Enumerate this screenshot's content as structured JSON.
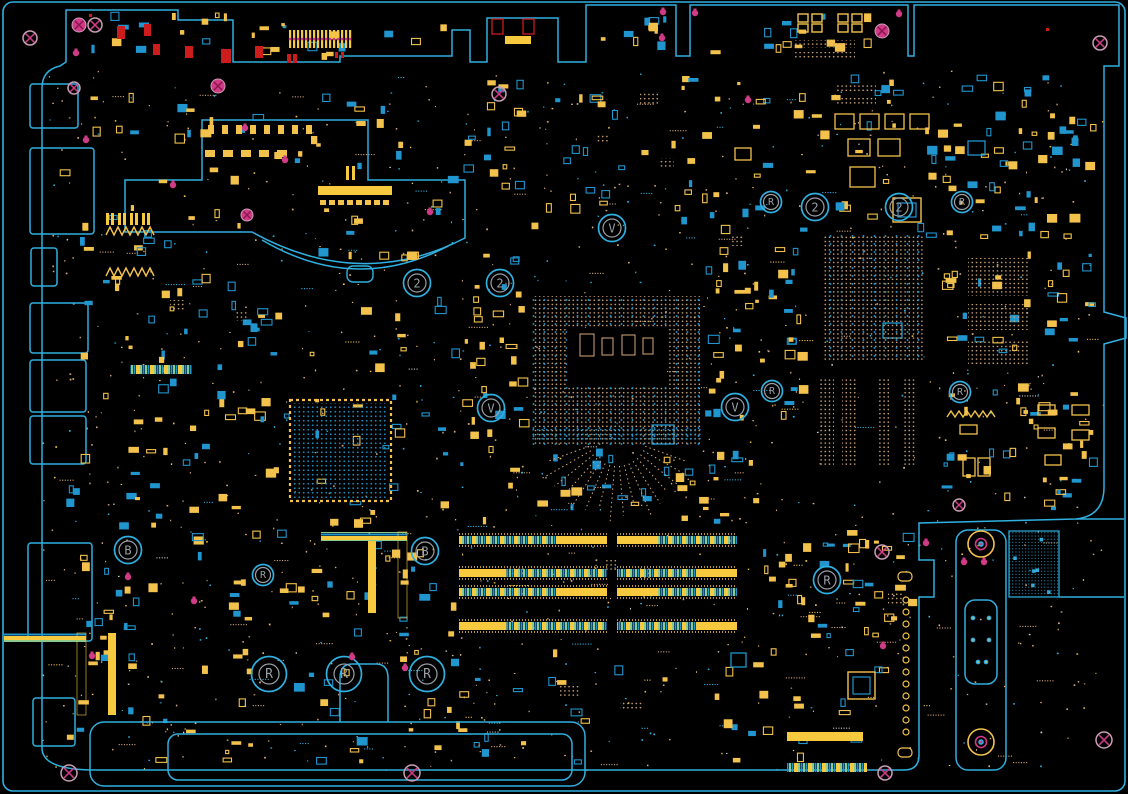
{
  "meta": {
    "type": "pcb-boardview",
    "width": 1128,
    "height": 794
  },
  "colors": {
    "bg": "#000000",
    "outline": "#2fb0e0",
    "blue": "#2095ce",
    "yellow": "#f2c24c",
    "yellowBright": "#f6c93f",
    "tan": "#d4a97c",
    "green": "#8cc98c",
    "magenta": "#d13a86",
    "magentaDark": "#8c1650",
    "grayPink": "#c89fb6",
    "red": "#cc1c1c",
    "gray": "#9aa0a6"
  },
  "outline_paths": {
    "main_board": "M 66,62 L 66,10 L 178,10 L 178,20 L 233,20 L 233,62 L 340,62 L 340,56 L 452,56 L 452,30 L 470,30 L 470,62 L 487,62 L 487,18 L 558,18 L 558,62 L 586,62 L 586,5 L 676,5 L 676,56 L 690,56 L 690,5 L 908,5 L 908,56 L 914,56 L 914,5 L 1119,5 L 1119,66 L 1104,66 L 1104,312 L 1126,318 L 1126,338 L 1104,344 L 1104,487 Q 1104,516 1076,519 L 919,523 L 919,560 L 934,560 L 934,597 L 919,597 L 919,755 Q 919,770 904,770 L 95,770 Q 42,770 42,748 L 42,88 Q 42,70 60,66 Z",
    "top_connector_block": "M 125,232 L 125,180 L 202,180 L 202,120 L 368,120 L 368,180 L 465,180 L 465,238 Q 360,292 252,232 L 125,232 Z",
    "heatsink_arc_echo": "M 262,240 Q 357,296 452,244",
    "edge_lines": "M 1076,519 L 1124,519 M 1059,597 L 1124,597"
  },
  "arc_tab": {
    "x": 347,
    "y": 266,
    "w": 26,
    "h": 16
  },
  "frame": {
    "x": 3,
    "y": 2,
    "w": 1122,
    "h": 789,
    "r": 10
  },
  "ports_left": [
    [
      30,
      84,
      48,
      44
    ],
    [
      30,
      148,
      64,
      86
    ],
    [
      31,
      248,
      26,
      38
    ],
    [
      30,
      303,
      58,
      50
    ],
    [
      30,
      360,
      56,
      52
    ],
    [
      30,
      416,
      56,
      48
    ],
    [
      28,
      543,
      64,
      98
    ],
    [
      33,
      698,
      42,
      48
    ]
  ],
  "markers": [
    {
      "label": "2",
      "x": 417,
      "y": 283,
      "size": "md"
    },
    {
      "label": "2",
      "x": 500,
      "y": 283,
      "size": "md"
    },
    {
      "label": "2",
      "x": 815,
      "y": 207,
      "size": "md"
    },
    {
      "label": "2",
      "x": 899,
      "y": 207,
      "size": "md"
    },
    {
      "label": "V",
      "x": 612,
      "y": 228,
      "size": "md"
    },
    {
      "label": "V",
      "x": 491,
      "y": 408,
      "size": "md"
    },
    {
      "label": "V",
      "x": 735,
      "y": 407,
      "size": "md"
    },
    {
      "label": "R",
      "x": 771,
      "y": 202,
      "size": "sm"
    },
    {
      "label": "R",
      "x": 962,
      "y": 202,
      "size": "sm"
    },
    {
      "label": "R",
      "x": 772,
      "y": 391,
      "size": "sm"
    },
    {
      "label": "R",
      "x": 960,
      "y": 392,
      "size": "sm"
    },
    {
      "label": "B",
      "x": 128,
      "y": 550,
      "size": "md"
    },
    {
      "label": "B",
      "x": 425,
      "y": 551,
      "size": "md"
    },
    {
      "label": "R",
      "x": 263,
      "y": 575,
      "size": "sm"
    },
    {
      "label": "R",
      "x": 827,
      "y": 580,
      "size": "md"
    },
    {
      "label": "R",
      "x": 269,
      "y": 674,
      "size": "big"
    },
    {
      "label": "R",
      "x": 344,
      "y": 674,
      "size": "big"
    },
    {
      "label": "R",
      "x": 427,
      "y": 674,
      "size": "big"
    }
  ],
  "marker_sizes": {
    "sm": {
      "outer": 10.5,
      "inner": 7.5,
      "font": 10
    },
    "md": {
      "outer": 13.5,
      "inner": 9,
      "font": 12
    },
    "big": {
      "outer": 17.5,
      "inner": 10,
      "font": 13
    }
  },
  "mount_holes_outline": [
    [
      95,
      25,
      7
    ],
    [
      30,
      38,
      7
    ],
    [
      74,
      88,
      6
    ],
    [
      499,
      94,
      7
    ],
    [
      1100,
      43,
      7
    ],
    [
      882,
      552,
      7
    ],
    [
      959,
      505,
      6
    ],
    [
      1104,
      740,
      8
    ],
    [
      885,
      773,
      7
    ],
    [
      69,
      773,
      8
    ],
    [
      412,
      773,
      8
    ]
  ],
  "mount_holes_filled": [
    [
      79,
      25,
      7
    ],
    [
      218,
      86,
      7
    ],
    [
      247,
      215,
      6
    ],
    [
      882,
      31,
      7
    ]
  ],
  "pink_pads": [
    [
      899,
      14
    ],
    [
      76,
      53
    ],
    [
      86,
      140
    ],
    [
      285,
      160
    ],
    [
      173,
      185
    ],
    [
      430,
      212
    ],
    [
      245,
      128
    ],
    [
      663,
      12
    ],
    [
      662,
      38
    ],
    [
      695,
      13
    ],
    [
      984,
      562
    ],
    [
      352,
      657
    ],
    [
      405,
      668
    ],
    [
      92,
      656
    ],
    [
      128,
      577
    ],
    [
      194,
      601
    ],
    [
      926,
      543
    ],
    [
      964,
      562
    ],
    [
      883,
      646
    ],
    [
      748,
      100
    ]
  ],
  "red_dots": [
    [
      1046,
      28
    ],
    [
      89,
      14
    ]
  ],
  "dimm": {
    "rows": [
      536,
      569,
      588,
      622
    ],
    "segments": [
      [
        459,
        148
      ],
      [
        617,
        120
      ]
    ],
    "height": 8
  },
  "bga_grids": [
    {
      "name": "cpu-socket",
      "x": 532,
      "y": 296,
      "w": 170,
      "h": 150,
      "kind": "mixed",
      "center_void": {
        "x": 567,
        "y": 328,
        "w": 100,
        "h": 58
      },
      "center_pads": [
        [
          580,
          334,
          14,
          22
        ],
        [
          602,
          338,
          11,
          17
        ],
        [
          622,
          335,
          13,
          20
        ],
        [
          643,
          338,
          10,
          16
        ]
      ],
      "blue_band": {
        "x": 532,
        "y": 428,
        "w": 170,
        "h": 12
      }
    },
    {
      "name": "pch",
      "x": 822,
      "y": 234,
      "w": 102,
      "h": 128,
      "kind": "mixed"
    },
    {
      "name": "pch-side-1",
      "x": 968,
      "y": 258,
      "w": 60,
      "h": 38,
      "kind": "tan"
    },
    {
      "name": "pch-side-2",
      "x": 968,
      "y": 304,
      "w": 60,
      "h": 26,
      "kind": "tan"
    },
    {
      "name": "pch-side-3",
      "x": 968,
      "y": 340,
      "w": 60,
      "h": 26,
      "kind": "tan"
    },
    {
      "name": "pch-col-1",
      "x": 820,
      "y": 378,
      "w": 14,
      "h": 88,
      "kind": "tan"
    },
    {
      "name": "pch-col-2",
      "x": 842,
      "y": 378,
      "w": 14,
      "h": 88,
      "kind": "tan"
    },
    {
      "name": "pch-col-3",
      "x": 877,
      "y": 378,
      "w": 14,
      "h": 88,
      "kind": "tan"
    },
    {
      "name": "pch-col-4",
      "x": 903,
      "y": 378,
      "w": 14,
      "h": 88,
      "kind": "tan"
    },
    {
      "name": "ec-chip",
      "x": 293,
      "y": 403,
      "w": 95,
      "h": 95,
      "kind": "blue-framed"
    }
  ],
  "rays": {
    "cx": 617,
    "cy": 436,
    "r1": 30,
    "r2": 72,
    "t1": 0.35,
    "t2": 2.79,
    "n": 16
  },
  "brackets": {
    "bottom": {
      "outer": {
        "x": 90,
        "y": 722,
        "w": 495,
        "h": 64,
        "r": 14
      },
      "inner": {
        "x": 168,
        "y": 734,
        "w": 404,
        "h": 46,
        "r": 10
      },
      "bump": "M 340,722 L 340,678 Q 340,664 352,664 L 376,664 Q 388,664 388,678 L 388,722"
    },
    "right": {
      "outer": {
        "x": 956,
        "y": 530,
        "w": 50,
        "h": 240,
        "r": 12
      },
      "waist": {
        "x": 965,
        "y": 600,
        "w": 32,
        "h": 84,
        "r": 10
      },
      "screws": [
        [
          981,
          544
        ],
        [
          981,
          742
        ]
      ],
      "dots": [
        [
          973,
          618
        ],
        [
          989,
          618
        ],
        [
          973,
          640
        ],
        [
          989,
          640
        ],
        [
          978,
          662
        ],
        [
          986,
          662
        ]
      ]
    },
    "hatch": {
      "x": 1009,
      "y": 531,
      "w": 50,
      "h": 66
    }
  },
  "hole_column": {
    "x": 906,
    "y0": 600,
    "n": 12,
    "dy": 12,
    "r": 3
  },
  "d_pads": [
    [
      898,
      572,
      14,
      9
    ],
    [
      898,
      748,
      14,
      9
    ]
  ],
  "components": [
    {
      "t": "rect",
      "x": 117,
      "y": 26,
      "w": 8,
      "h": 13,
      "c": "red",
      "f": true
    },
    {
      "t": "rect",
      "x": 144,
      "y": 24,
      "w": 7,
      "h": 12,
      "c": "red",
      "f": true
    },
    {
      "t": "rect",
      "x": 153,
      "y": 44,
      "w": 7,
      "h": 11,
      "c": "red",
      "f": true
    },
    {
      "t": "rect",
      "x": 185,
      "y": 46,
      "w": 8,
      "h": 12,
      "c": "red",
      "f": true
    },
    {
      "t": "rect",
      "x": 221,
      "y": 49,
      "w": 10,
      "h": 14,
      "c": "red",
      "f": true
    },
    {
      "t": "rect",
      "x": 255,
      "y": 46,
      "w": 8,
      "h": 12,
      "c": "red",
      "f": true
    },
    {
      "t": "rect",
      "x": 287,
      "y": 54,
      "w": 4,
      "h": 9,
      "c": "red",
      "f": true
    },
    {
      "t": "rect",
      "x": 293,
      "y": 54,
      "w": 4,
      "h": 9,
      "c": "red",
      "f": true
    },
    {
      "t": "rect",
      "x": 492,
      "y": 19,
      "w": 11,
      "h": 15,
      "c": "red",
      "f": false
    },
    {
      "t": "rect",
      "x": 523,
      "y": 19,
      "w": 11,
      "h": 15,
      "c": "red",
      "f": false
    },
    {
      "t": "rect",
      "x": 505,
      "y": 36,
      "w": 26,
      "h": 8,
      "c": "yellowBright",
      "f": true
    },
    {
      "t": "pinstrip",
      "x": 289,
      "y": 30,
      "w": 64,
      "h": 18
    },
    {
      "t": "dual",
      "x": 798,
      "y": 14,
      "w": 10,
      "h": 18
    },
    {
      "t": "dual",
      "x": 812,
      "y": 14,
      "w": 10,
      "h": 18
    },
    {
      "t": "dual",
      "x": 838,
      "y": 14,
      "w": 10,
      "h": 18
    },
    {
      "t": "dual",
      "x": 852,
      "y": 14,
      "w": 10,
      "h": 18
    },
    {
      "t": "rect",
      "x": 835,
      "y": 114,
      "w": 19,
      "h": 15,
      "c": "yellow",
      "f": false
    },
    {
      "t": "rect",
      "x": 860,
      "y": 114,
      "w": 19,
      "h": 15,
      "c": "yellow",
      "f": false
    },
    {
      "t": "rect",
      "x": 885,
      "y": 114,
      "w": 19,
      "h": 15,
      "c": "yellow",
      "f": false
    },
    {
      "t": "rect",
      "x": 910,
      "y": 114,
      "w": 19,
      "h": 15,
      "c": "yellow",
      "f": false
    },
    {
      "t": "rect",
      "x": 848,
      "y": 139,
      "w": 22,
      "h": 17,
      "c": "yellow",
      "f": false
    },
    {
      "t": "rect",
      "x": 878,
      "y": 139,
      "w": 22,
      "h": 17,
      "c": "yellow",
      "f": false
    },
    {
      "t": "rect",
      "x": 850,
      "y": 167,
      "w": 25,
      "h": 20,
      "c": "yellow",
      "f": false
    },
    {
      "t": "nested",
      "x": 893,
      "y": 198,
      "w": 28,
      "h": 24
    },
    {
      "t": "rect",
      "x": 735,
      "y": 148,
      "w": 16,
      "h": 12,
      "c": "yellow",
      "f": false
    },
    {
      "t": "rect",
      "x": 968,
      "y": 141,
      "w": 17,
      "h": 14,
      "c": "blue",
      "f": false
    },
    {
      "t": "rect",
      "x": 883,
      "y": 323,
      "w": 19,
      "h": 15,
      "c": "blue",
      "f": false
    },
    {
      "t": "rect",
      "x": 652,
      "y": 425,
      "w": 22,
      "h": 19,
      "c": "blue",
      "f": false
    },
    {
      "t": "rect",
      "x": 731,
      "y": 653,
      "w": 15,
      "h": 14,
      "c": "blue",
      "f": false
    },
    {
      "t": "nested",
      "x": 848,
      "y": 672,
      "w": 27,
      "h": 27
    },
    {
      "t": "rect",
      "x": 960,
      "y": 425,
      "w": 17,
      "h": 9,
      "c": "yellow",
      "f": false
    },
    {
      "t": "rect",
      "x": 1038,
      "y": 405,
      "w": 17,
      "h": 10,
      "c": "yellow",
      "f": false
    },
    {
      "t": "rect",
      "x": 1072,
      "y": 405,
      "w": 17,
      "h": 10,
      "c": "yellow",
      "f": false
    },
    {
      "t": "rect",
      "x": 1038,
      "y": 428,
      "w": 17,
      "h": 10,
      "c": "yellow",
      "f": false
    },
    {
      "t": "rect",
      "x": 1072,
      "y": 430,
      "w": 17,
      "h": 10,
      "c": "yellow",
      "f": false
    },
    {
      "t": "rect",
      "x": 963,
      "y": 458,
      "w": 12,
      "h": 18,
      "c": "yellow",
      "f": false
    },
    {
      "t": "rect",
      "x": 978,
      "y": 458,
      "w": 12,
      "h": 18,
      "c": "yellow",
      "f": false
    },
    {
      "t": "rect",
      "x": 1045,
      "y": 455,
      "w": 16,
      "h": 10,
      "c": "yellow",
      "f": false
    },
    {
      "t": "zigzag",
      "x": 947,
      "y": 411,
      "w": 50,
      "h": 6
    },
    {
      "t": "zigzag",
      "x": 106,
      "y": 227,
      "w": 48,
      "h": 8
    },
    {
      "t": "zigzag",
      "x": 106,
      "y": 268,
      "w": 48,
      "h": 8
    },
    {
      "t": "pins",
      "x": 106,
      "y": 213
    },
    {
      "t": "pins",
      "x": 118,
      "y": 213
    },
    {
      "t": "pins",
      "x": 130,
      "y": 213
    },
    {
      "t": "pins",
      "x": 142,
      "y": 213
    },
    {
      "t": "bar",
      "x": 318,
      "y": 186,
      "w": 74,
      "h": 9,
      "c": "yellowBright"
    },
    {
      "t": "stripeH",
      "x": 130,
      "y": 365,
      "w": 62,
      "h": 9
    },
    {
      "t": "stripeH",
      "x": 787,
      "y": 763,
      "w": 80,
      "h": 9
    },
    {
      "t": "bar",
      "x": 787,
      "y": 732,
      "w": 76,
      "h": 9,
      "c": "yellowBright"
    },
    {
      "t": "stripeV",
      "x": 77,
      "y": 633,
      "w": 9,
      "h": 82
    },
    {
      "t": "bar",
      "x": 108,
      "y": 633,
      "w": 8,
      "h": 82,
      "c": "yellowBright"
    },
    {
      "t": "bar",
      "x": 368,
      "y": 537,
      "w": 8,
      "h": 76,
      "c": "yellowBright"
    },
    {
      "t": "stripeV",
      "x": 398,
      "y": 532,
      "w": 9,
      "h": 86
    },
    {
      "t": "dotpatch",
      "x": 888,
      "y": 592,
      "w": 16,
      "h": 12
    },
    {
      "t": "dotpatch",
      "x": 604,
      "y": 560,
      "w": 14,
      "h": 10
    },
    {
      "t": "dotpatch",
      "x": 508,
      "y": 566,
      "w": 16,
      "h": 10
    },
    {
      "t": "dotpatch",
      "x": 640,
      "y": 568,
      "w": 12,
      "h": 10
    },
    {
      "t": "dotpatch",
      "x": 560,
      "y": 686,
      "w": 20,
      "h": 12
    },
    {
      "t": "dotpatch",
      "x": 620,
      "y": 700,
      "w": 24,
      "h": 10
    },
    {
      "t": "dotpatch",
      "x": 730,
      "y": 236,
      "w": 14,
      "h": 10
    },
    {
      "t": "dotpatch",
      "x": 640,
      "y": 92,
      "w": 18,
      "h": 12
    },
    {
      "t": "dotpatch",
      "x": 597,
      "y": 134,
      "w": 12,
      "h": 10
    },
    {
      "t": "dotpatch",
      "x": 660,
      "y": 158,
      "w": 14,
      "h": 10
    },
    {
      "t": "dotpatch",
      "x": 170,
      "y": 300,
      "w": 14,
      "h": 10
    },
    {
      "t": "dotpatch",
      "x": 235,
      "y": 312,
      "w": 12,
      "h": 9
    },
    {
      "t": "dotpatch",
      "x": 836,
      "y": 83,
      "w": 40,
      "h": 10
    },
    {
      "t": "dotpatch",
      "x": 836,
      "y": 97,
      "w": 40,
      "h": 8
    },
    {
      "t": "dotpatch",
      "x": 795,
      "y": 40,
      "w": 60,
      "h": 8
    },
    {
      "t": "dotpatch",
      "x": 795,
      "y": 52,
      "w": 60,
      "h": 6
    },
    {
      "t": "padrow",
      "x": 208,
      "y": 125,
      "n": 8,
      "dx": 14,
      "w": 6,
      "h": 9
    },
    {
      "t": "padrow",
      "x": 205,
      "y": 150,
      "n": 5,
      "dx": 18,
      "w": 10,
      "h": 7
    },
    {
      "t": "padrow",
      "x": 320,
      "y": 200,
      "n": 8,
      "dx": 9,
      "w": 6,
      "h": 5
    },
    {
      "t": "bar",
      "x": 346,
      "y": 166,
      "w": 3,
      "h": 14,
      "c": "yellowBright"
    },
    {
      "t": "bar",
      "x": 352,
      "y": 166,
      "w": 3,
      "h": 14,
      "c": "yellowBright"
    }
  ],
  "scatter_fields": [
    {
      "x": 60,
      "y": 88,
      "w": 400,
      "h": 180,
      "n": 55
    },
    {
      "x": 60,
      "y": 270,
      "w": 240,
      "h": 260,
      "n": 70
    },
    {
      "x": 310,
      "y": 240,
      "w": 215,
      "h": 290,
      "n": 45
    },
    {
      "x": 460,
      "y": 75,
      "w": 450,
      "h": 160,
      "n": 80
    },
    {
      "x": 915,
      "y": 75,
      "w": 185,
      "h": 165,
      "n": 60
    },
    {
      "x": 940,
      "y": 245,
      "w": 160,
      "h": 270,
      "n": 70
    },
    {
      "x": 460,
      "y": 445,
      "w": 300,
      "h": 80,
      "n": 35
    },
    {
      "x": 60,
      "y": 530,
      "w": 400,
      "h": 110,
      "n": 50
    },
    {
      "x": 60,
      "y": 645,
      "w": 840,
      "h": 120,
      "n": 80
    },
    {
      "x": 760,
      "y": 530,
      "w": 158,
      "h": 110,
      "n": 40
    },
    {
      "x": 700,
      "y": 245,
      "w": 110,
      "h": 180,
      "n": 40
    },
    {
      "x": 470,
      "y": 240,
      "w": 60,
      "h": 200,
      "n": 20
    },
    {
      "x": 595,
      "y": 10,
      "w": 75,
      "h": 45,
      "n": 10
    },
    {
      "x": 700,
      "y": 10,
      "w": 200,
      "h": 45,
      "n": 14
    },
    {
      "x": 70,
      "y": 12,
      "w": 160,
      "h": 45,
      "n": 12
    },
    {
      "x": 240,
      "y": 20,
      "w": 210,
      "h": 40,
      "n": 14
    }
  ],
  "speckle": {
    "seed": 77,
    "n": 1100,
    "region": [
      42,
      70,
      1062,
      700
    ]
  }
}
